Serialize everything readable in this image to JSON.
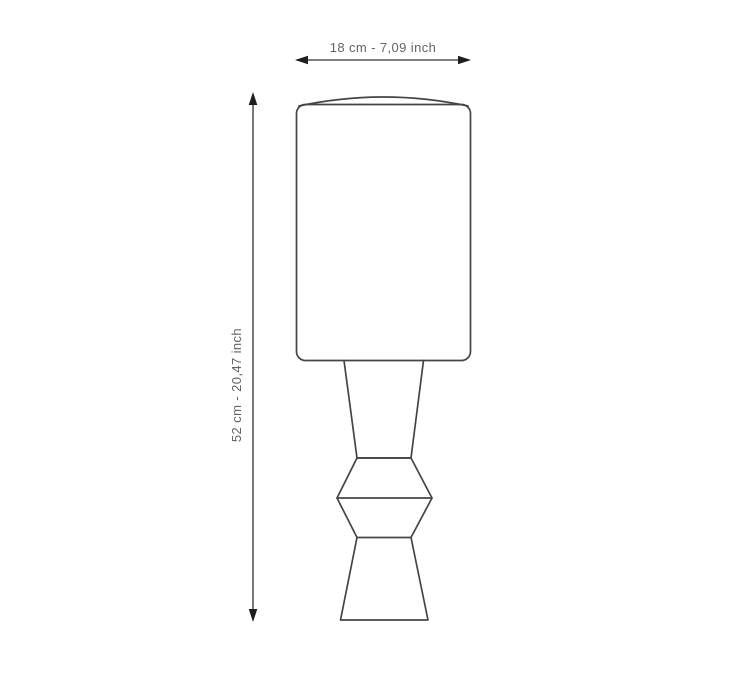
{
  "page": {
    "background_color": "#ffffff"
  },
  "diagram": {
    "subject": "table-lamp-dimension-drawing",
    "colors": {
      "outline": "#454545",
      "dimension_line": "#565656",
      "arrow": "#1e1e1e",
      "text": "#646464"
    },
    "dimensions": {
      "width": {
        "label": "18 cm - 7,09 inch"
      },
      "height": {
        "label": "52 cm - 20,47 inch"
      }
    }
  }
}
